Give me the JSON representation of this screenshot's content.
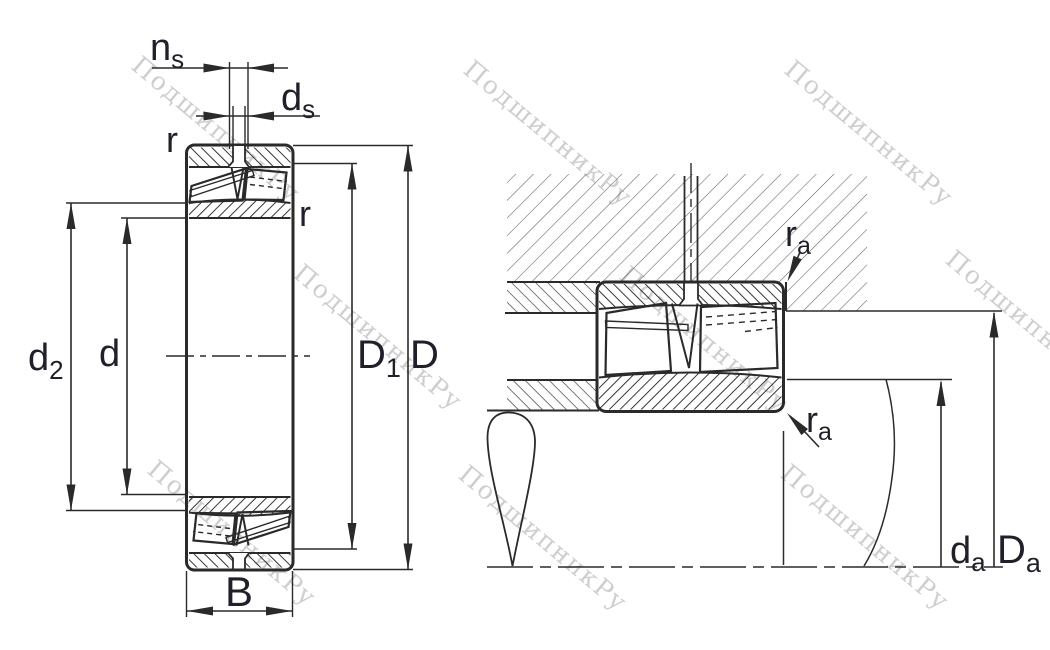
{
  "drawing": {
    "title": "spherical-roller-bearing-dimension-drawing",
    "views": {
      "left": "bearing-cross-section",
      "right": "bearing-mounted-in-housing-and-shaft"
    }
  },
  "labels": {
    "ns": {
      "main": "n",
      "sub": "s"
    },
    "ds": {
      "main": "d",
      "sub": "s"
    },
    "r_top": "r",
    "r_right": "r",
    "d2": {
      "main": "d",
      "sub": "2"
    },
    "d": "d",
    "D1": {
      "main": "D",
      "sub": "1"
    },
    "D": "D",
    "B": "B",
    "ra_top": {
      "main": "r",
      "sub": "a"
    },
    "ra_bottom": {
      "main": "r",
      "sub": "a"
    },
    "da": {
      "main": "d",
      "sub": "a"
    },
    "Da": {
      "main": "D",
      "sub": "a"
    }
  },
  "watermark": {
    "text": "ПодшипникРу",
    "color": "#c2c2c2"
  },
  "colors": {
    "line": "#2a2a2a",
    "label": "#20202b",
    "ring_hatch": "#1f1f1f",
    "housing_hatch": "#616161",
    "background": "#ffffff"
  }
}
